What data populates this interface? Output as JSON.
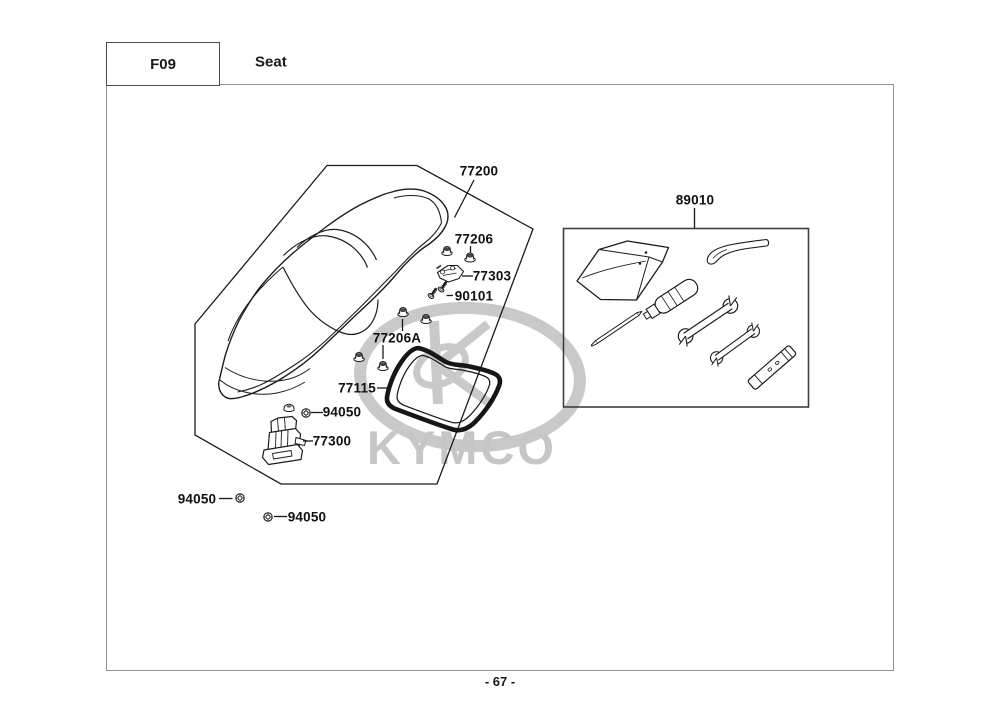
{
  "header": {
    "section_code": "F09",
    "section_title": "Seat"
  },
  "footer": {
    "page_number": "- 67 -"
  },
  "watermark": {
    "text": "KYMCO"
  },
  "labels": {
    "seat": "77200",
    "toolkit": "89010",
    "nut_a": "77206",
    "bracket": "77303",
    "screw": "90101",
    "nut_b": "77206A",
    "seal": "77115",
    "bolt_1": "94050",
    "latch": "77300",
    "bolt_2": "94050",
    "bolt_3": "94050"
  }
}
